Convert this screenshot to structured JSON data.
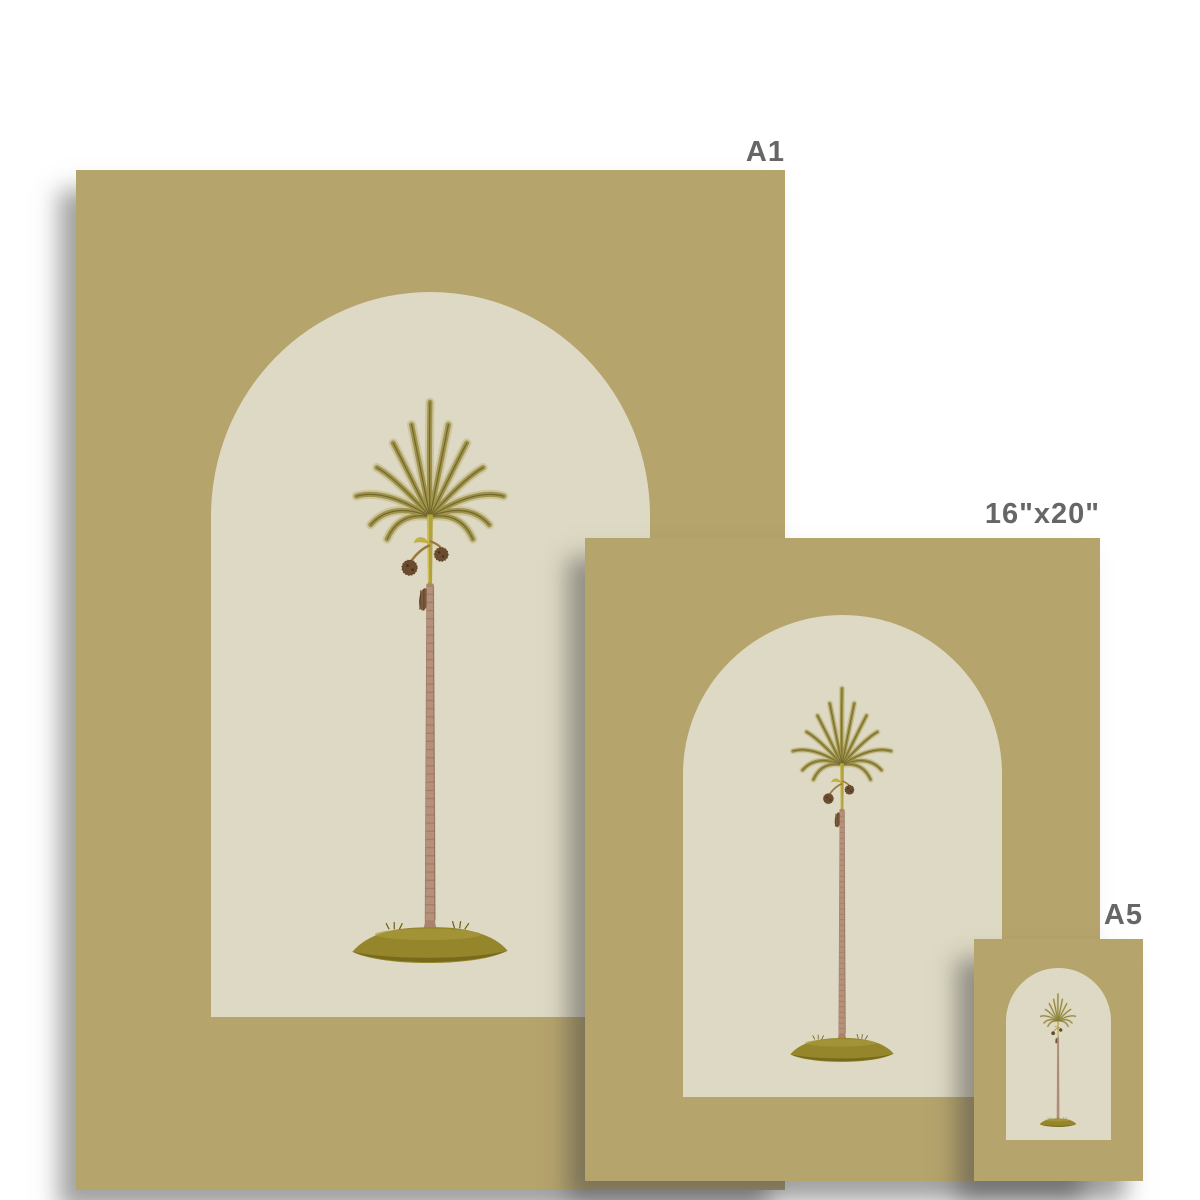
{
  "page": {
    "kind": "print-size-comparison",
    "background": "#ffffff"
  },
  "colors": {
    "poster_bg": "#b5a46c",
    "arch_bg": "#ded9c4",
    "label_text": "#666666",
    "shadow_color": "rgba(70,70,70,0.5)"
  },
  "prints": [
    {
      "id": "a1",
      "label": "A1"
    },
    {
      "id": "16x20",
      "label": "16\"x20\""
    },
    {
      "id": "a5",
      "label": "A5"
    }
  ],
  "artwork": {
    "icon": "palm-tree-illustration",
    "motif": "vintage palm tree in cream arch on tan background"
  }
}
